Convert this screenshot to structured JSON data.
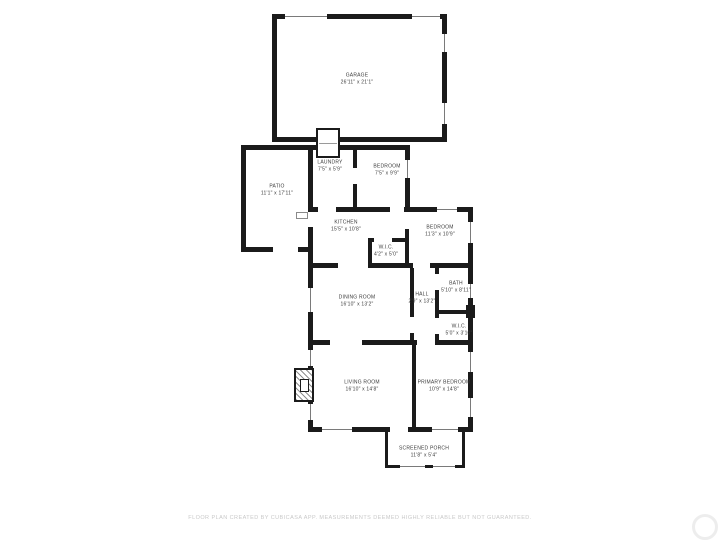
{
  "plan": {
    "rooms": [
      {
        "id": "garage",
        "name": "GARAGE",
        "dims": "26'11\" x 21'1\""
      },
      {
        "id": "patio",
        "name": "PATIO",
        "dims": "11'1\" x 17'11\""
      },
      {
        "id": "laundry",
        "name": "LAUNDRY",
        "dims": "7'5\" x 5'9\""
      },
      {
        "id": "bedroom-top",
        "name": "BEDROOM",
        "dims": "7'5\" x 9'9\""
      },
      {
        "id": "kitchen",
        "name": "KITCHEN",
        "dims": "15'5\" x 10'8\""
      },
      {
        "id": "bedroom-right",
        "name": "BEDROOM",
        "dims": "11'3\" x 10'9\""
      },
      {
        "id": "wic-upper",
        "name": "W.I.C.",
        "dims": "4'2\" x 5'0\""
      },
      {
        "id": "dining-room",
        "name": "DINING ROOM",
        "dims": "16'10\" x 13'2\""
      },
      {
        "id": "hall",
        "name": "HALL",
        "dims": "2'9\" x 13'2\""
      },
      {
        "id": "bath",
        "name": "BATH",
        "dims": "5'10\" x 8'11\""
      },
      {
        "id": "wic-lower",
        "name": "W.I.C.",
        "dims": "5'0\" x 3'10\""
      },
      {
        "id": "living-room",
        "name": "LIVING ROOM",
        "dims": "16'10\" x 14'8\""
      },
      {
        "id": "primary-bedroom",
        "name": "PRIMARY BEDROOM",
        "dims": "10'9\" x 14'8\""
      },
      {
        "id": "screened-porch",
        "name": "SCREENED PORCH",
        "dims": "11'8\" x 5'4\""
      }
    ],
    "disclaimer": "FLOOR PLAN CREATED BY CUBICASA APP. MEASUREMENTS DEEMED HIGHLY RELIABLE BUT NOT GUARANTEED.",
    "colors": {
      "wall": "#1b1b1b",
      "background": "#ffffff",
      "label_text": "#3c3c3c",
      "disclaimer_text": "#c9c9c9"
    }
  }
}
